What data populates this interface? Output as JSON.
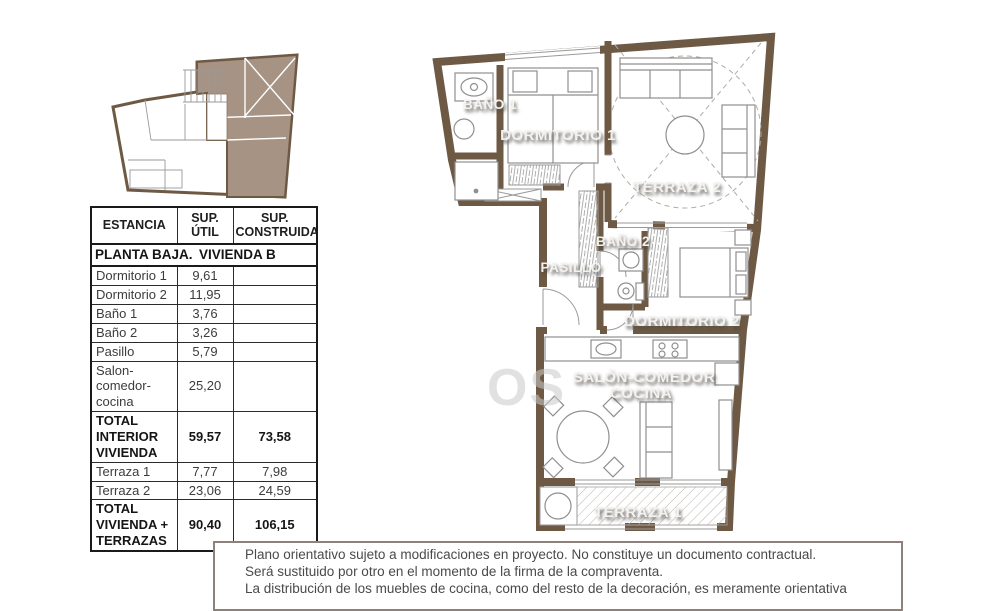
{
  "colors": {
    "wall": "#6e5a44",
    "highlight_unit_fill": "#a69383",
    "furniture_line": "#8f8f8f",
    "room_label_text": "#f4f2ee",
    "table_border": "#1a1a1a",
    "disclaimer_border": "#8e807a"
  },
  "table": {
    "headers": {
      "estancia": "ESTANCIA",
      "util": "SUP. ÚTIL",
      "construida": "SUP. CONSTRUIDA"
    },
    "section": {
      "left": "PLANTA BAJA.",
      "right": "VIVIENDA B"
    },
    "rows": [
      {
        "name": "Dormitorio 1",
        "util": "9,61",
        "cons": ""
      },
      {
        "name": "Dormitorio 2",
        "util": "11,95",
        "cons": ""
      },
      {
        "name": "Baño 1",
        "util": "3,76",
        "cons": ""
      },
      {
        "name": "Baño 2",
        "util": "3,26",
        "cons": ""
      },
      {
        "name": "Pasillo",
        "util": "5,79",
        "cons": ""
      },
      {
        "name": "Salon-comedor-cocina",
        "util": "25,20",
        "cons": ""
      },
      {
        "name": "TOTAL INTERIOR VIVIENDA",
        "util": "59,57",
        "cons": "73,58"
      },
      {
        "name": "Terraza 1",
        "util": "7,77",
        "cons": "7,98"
      },
      {
        "name": "Terraza 2",
        "util": "23,06",
        "cons": "24,59"
      },
      {
        "name": "TOTAL VIVIENDA + TERRAZAS",
        "util": "90,40",
        "cons": "106,15"
      }
    ]
  },
  "plan": {
    "rooms": [
      {
        "label": "BAÑO 1"
      },
      {
        "label": "DORMITORIO 1"
      },
      {
        "label": "TERRAZA 2"
      },
      {
        "label": "BAÑO 2"
      },
      {
        "label": "PASILLO"
      },
      {
        "label": "DORMITORIO 2"
      },
      {
        "label": "SALÓN-COMEDOR"
      },
      {
        "label": "COCINA"
      },
      {
        "label": "TERRAZA 1"
      }
    ]
  },
  "watermark": {
    "text": "OS"
  },
  "disclaimer": {
    "lines": [
      "Plano orientativo sujeto a modificaciones en proyecto. No constituye un documento contractual.",
      "Será sustituido por otro en el momento de la firma de la compraventa.",
      "La distribución de los muebles de cocina, como del resto de la decoración, es meramente orientativa"
    ]
  }
}
